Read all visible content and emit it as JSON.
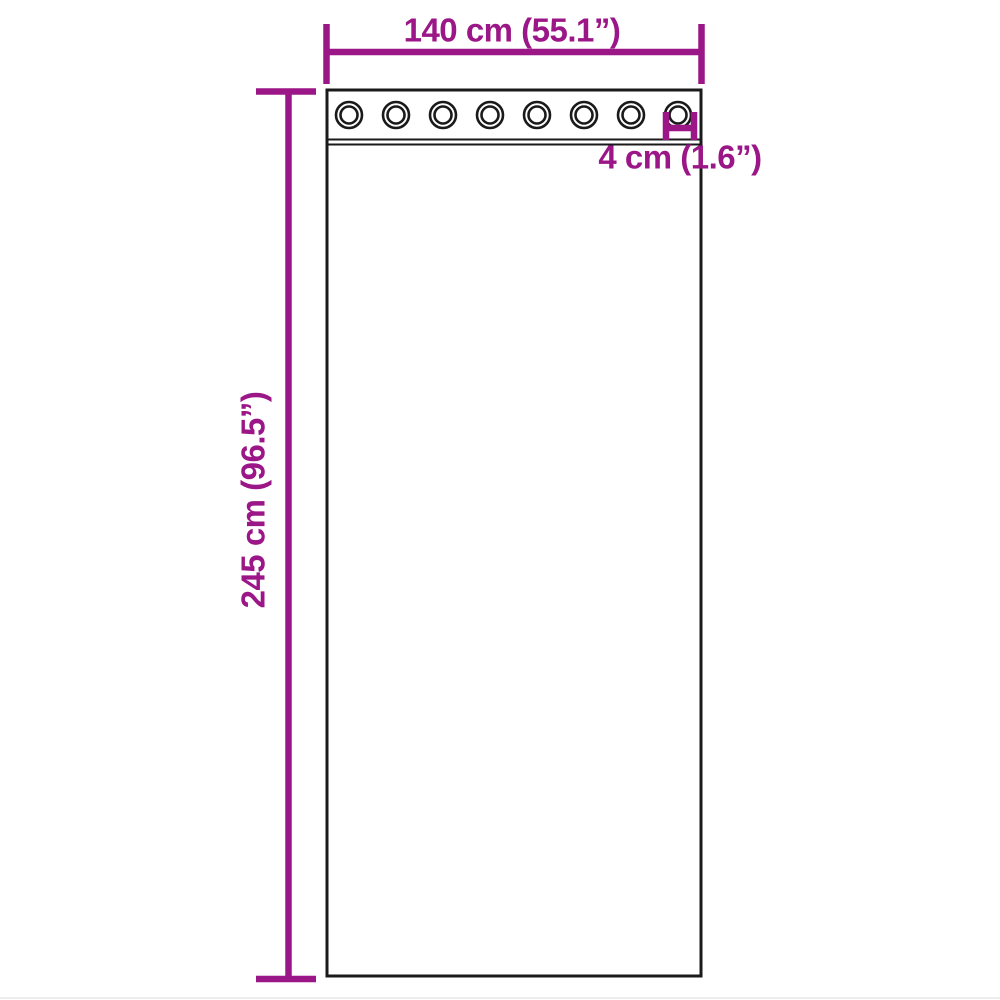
{
  "diagram": {
    "type": "product-dimension-diagram",
    "subject": "curtain-with-grommets",
    "labels": {
      "width": "140 cm (55.1”)",
      "height": "245 cm (96.5”)",
      "grommet": "4 cm (1.6”)"
    },
    "grommets": {
      "count": 8
    },
    "colors": {
      "dimension": "#9B1687",
      "outline": "#1A1A1A",
      "background": "#FFFFFF"
    }
  }
}
